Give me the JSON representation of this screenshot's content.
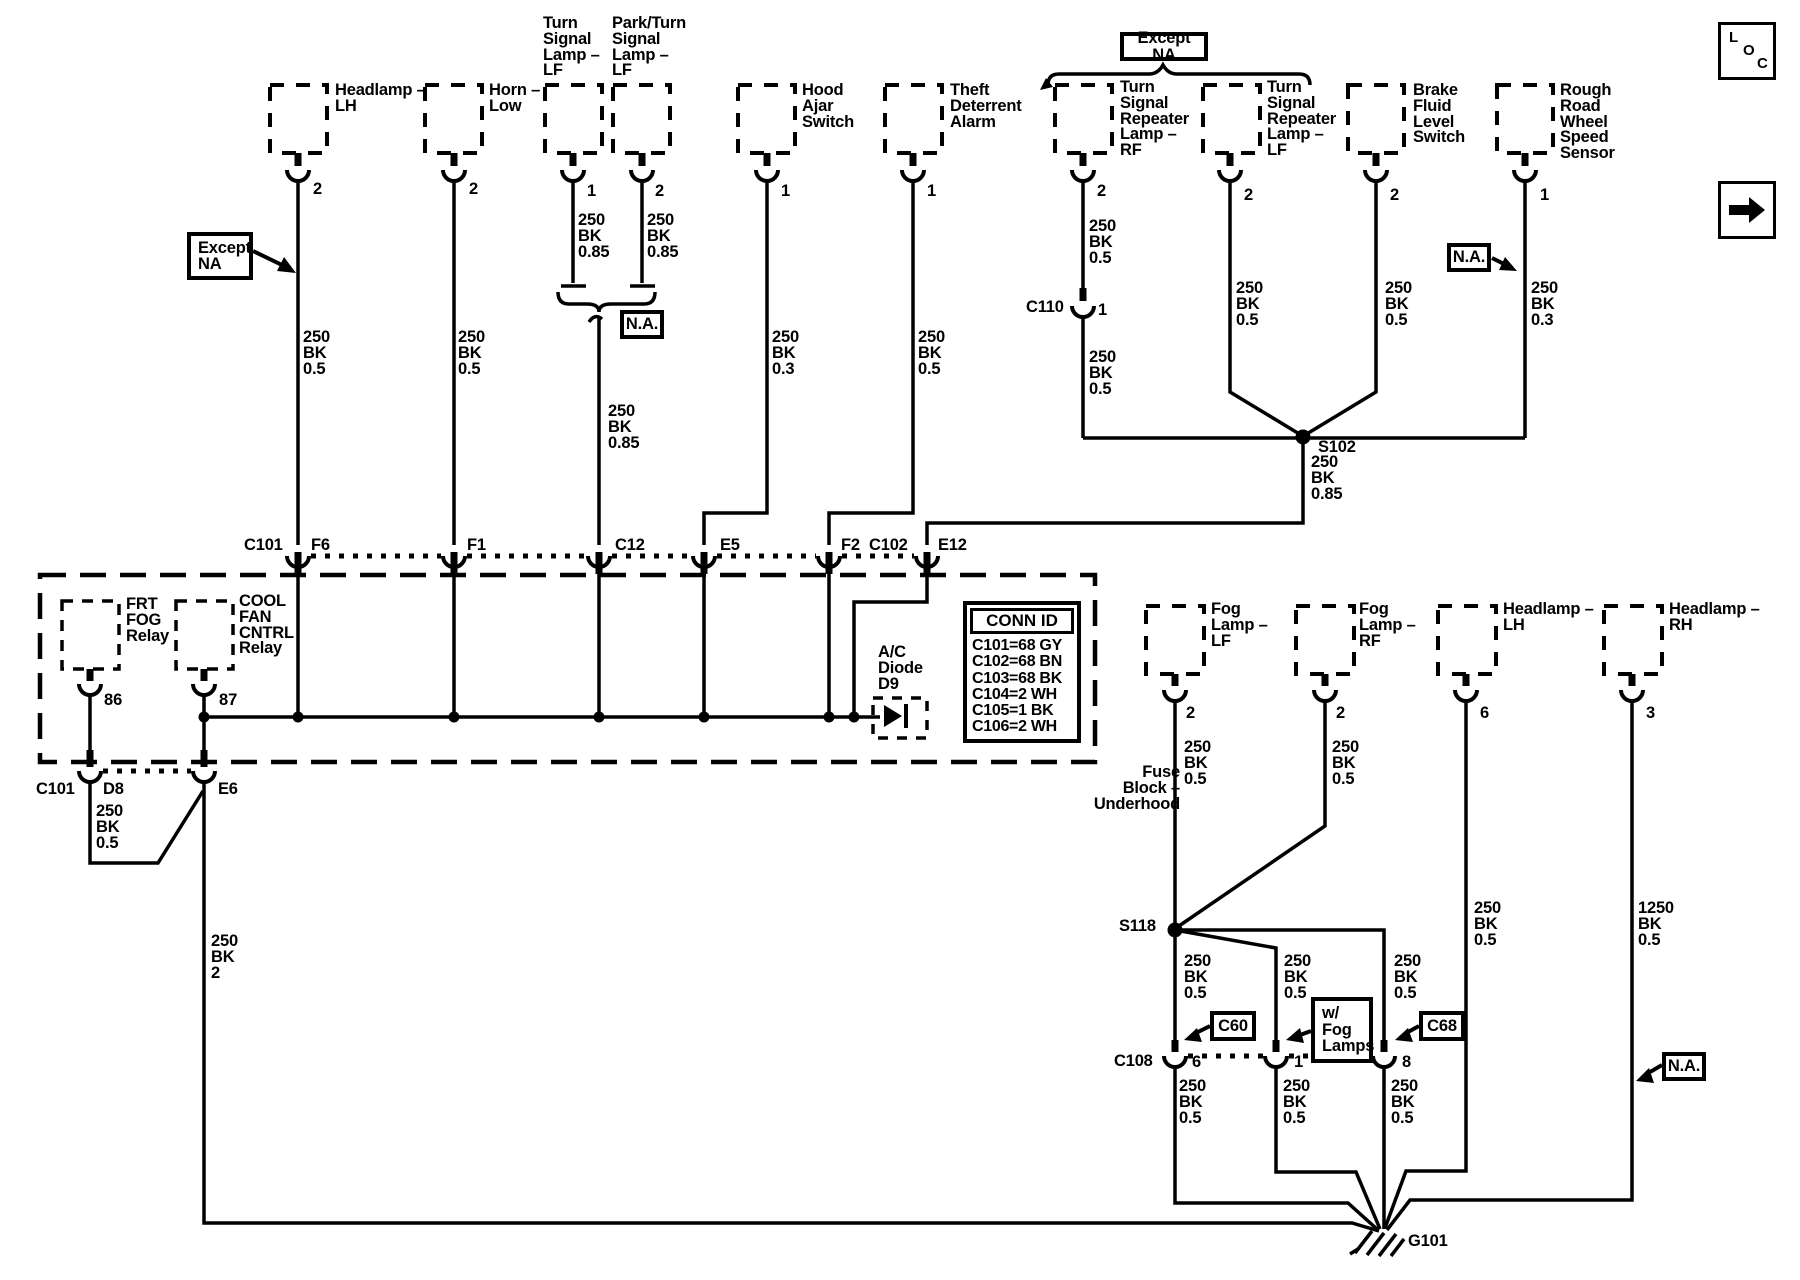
{
  "colors": {
    "ink": "#000000",
    "paper": "#ffffff"
  },
  "nav": {
    "loc": [
      "L",
      "O",
      "C"
    ]
  },
  "annotations": {
    "except_na_left": "Except\nNA",
    "except_na_top": "Except NA",
    "na_mid": "N.A.",
    "na_rough": "N.A.",
    "na_bottom": "N.A.",
    "c60": "C60",
    "c68": "C68",
    "w_fog_lamps": "w/\nFog\nLamps"
  },
  "top_components": [
    {
      "label": "Headlamp –\nLH",
      "pin": "2",
      "wire": "250\nBK\n0.5"
    },
    {
      "label": "Horn –\nLow",
      "pin": "2",
      "wire": "250\nBK\n0.5"
    },
    {
      "label": "Turn\nSignal\nLamp –\nLF",
      "pin": "1",
      "wire": "250\nBK\n0.85"
    },
    {
      "label": "Park/Turn\nSignal\nLamp –\nLF",
      "pin": "2",
      "wire": "250\nBK\n0.85"
    },
    {
      "label": "Hood\nAjar\nSwitch",
      "pin": "1",
      "wire": "250\nBK\n0.3"
    },
    {
      "label": "Theft\nDeterrent\nAlarm",
      "pin": "1",
      "wire": "250\nBK\n0.5"
    },
    {
      "label": "Turn\nSignal\nRepeater\nLamp –\nRF",
      "pin": "2",
      "wire": "250\nBK\n0.5"
    },
    {
      "label": "Turn\nSignal\nRepeater\nLamp –\nLF",
      "pin": "2",
      "wire": "250\nBK\n0.5"
    },
    {
      "label": "Brake\nFluid\nLevel\nSwitch",
      "pin": "2",
      "wire": "250\nBK\n0.5"
    },
    {
      "label": "Rough\nRoad\nWheel\nSpeed\nSensor",
      "pin": "1",
      "wire": "250\nBK\n0.3"
    }
  ],
  "merged_turn_park_wire": "250\nBK\n0.85",
  "c110": {
    "label": "C110",
    "pin": "1",
    "wire_below": "250\nBK\n0.5"
  },
  "s102": {
    "label": "S102",
    "wire_below": "250\nBK\n0.85"
  },
  "connector_row": {
    "c101": "C101",
    "f6": "F6",
    "f1": "F1",
    "c12": "C12",
    "e5": "E5",
    "f2": "F2",
    "c102": "C102",
    "e12": "E12"
  },
  "fuse_block": {
    "label": "Fuse\nBlock –\nUnderhood",
    "frt_fog_relay": {
      "label": "FRT\nFOG\nRelay",
      "pin": "86"
    },
    "cool_fan_cntrl_relay": {
      "label": "COOL\nFAN\nCNTRL\nRelay",
      "pin": "87"
    },
    "ac_diode": {
      "label": "A/C\nDiode\nD9"
    },
    "conn_id": {
      "title": "CONN ID",
      "rows": [
        "C101=68 GY",
        "C102=68 BN",
        "C103=68 BK",
        "C104=2 WH",
        "C105=1 BK",
        "C106=2 WH"
      ]
    }
  },
  "below_fuse_block": {
    "c101": "C101",
    "d8": {
      "label": "D8",
      "wire": "250\nBK\n0.5"
    },
    "e6": {
      "label": "E6",
      "wire": "250\nBK\n2"
    }
  },
  "bottom_components": [
    {
      "label": "Fog\nLamp –\nLF",
      "pin": "2",
      "wire": "250\nBK\n0.5"
    },
    {
      "label": "Fog\nLamp –\nRF",
      "pin": "2",
      "wire": "250\nBK\n0.5"
    },
    {
      "label": "Headlamp –\nLH",
      "pin": "6",
      "wire": "250\nBK\n0.5"
    },
    {
      "label": "Headlamp –\nRH",
      "pin": "3",
      "wire": "1250\nBK\n0.5"
    }
  ],
  "s118": {
    "label": "S118",
    "branches": [
      "250\nBK\n0.5",
      "250\nBK\n0.5",
      "250\nBK\n0.5"
    ]
  },
  "c108": {
    "label": "C108",
    "pins": [
      "6",
      "1",
      "8"
    ],
    "wires": [
      "250\nBK\n0.5",
      "250\nBK\n0.5",
      "250\nBK\n0.5"
    ]
  },
  "ground": {
    "label": "G101"
  }
}
